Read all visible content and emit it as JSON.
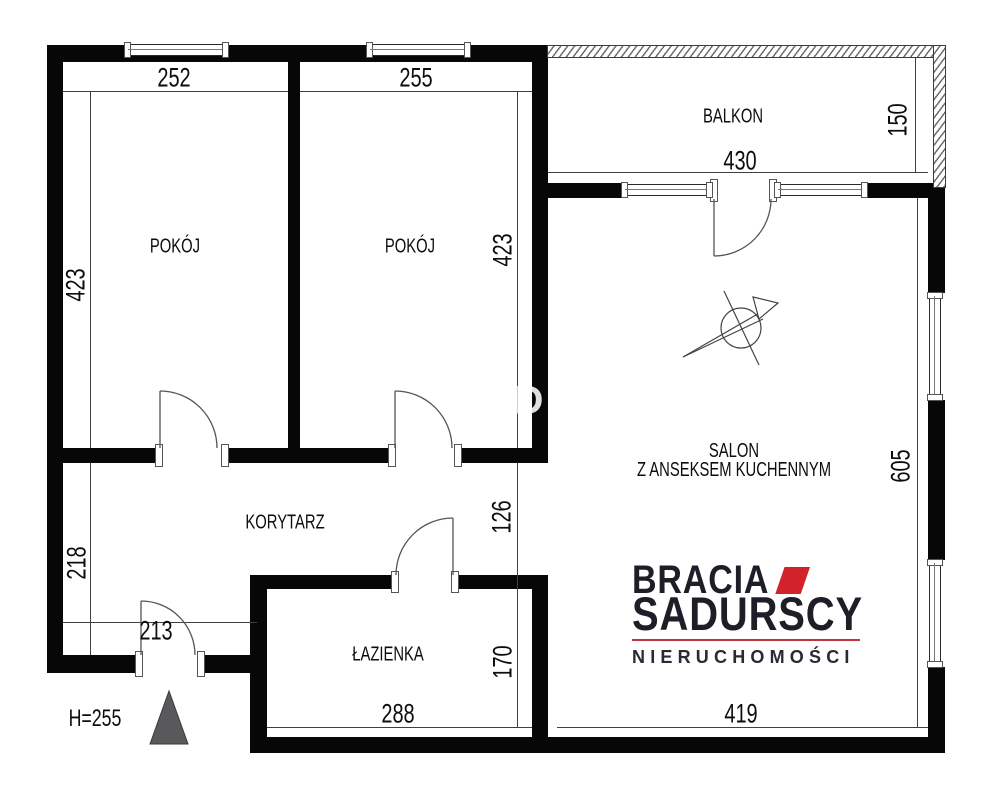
{
  "floorplan": {
    "rooms": [
      {
        "id": "pokoj-1",
        "label": "POKÓJ",
        "width_cm": "252",
        "height_cm": "423"
      },
      {
        "id": "pokoj-2",
        "label": "POKÓJ",
        "width_cm": "255",
        "height_cm": "423"
      },
      {
        "id": "balkon",
        "label": "BALKON",
        "width_cm": "430",
        "depth_cm": "150"
      },
      {
        "id": "salon",
        "label_line1": "SALON",
        "label_line2": "Z ANSEKSEM KUCHENNYM",
        "height_cm": "605",
        "width_cm": "419"
      },
      {
        "id": "korytarz",
        "label": "KORYTARZ",
        "height_cm": "218",
        "entry_dim_cm": "213",
        "passage_cm": "126"
      },
      {
        "id": "lazienka",
        "label": "ŁAZIENKA",
        "width_cm": "288",
        "height_cm": "170"
      }
    ],
    "ceiling_height_label": "H=255",
    "watermark_letter": "D",
    "wall_color": "#070707",
    "dimension_line_color": "#404040"
  },
  "logo": {
    "line1": "BRACIA",
    "line2": "SADURSCY",
    "tagline": "NIERUCHOMOŚCI",
    "accent_color": "#d2232a",
    "text_color": "#1e1e28"
  }
}
